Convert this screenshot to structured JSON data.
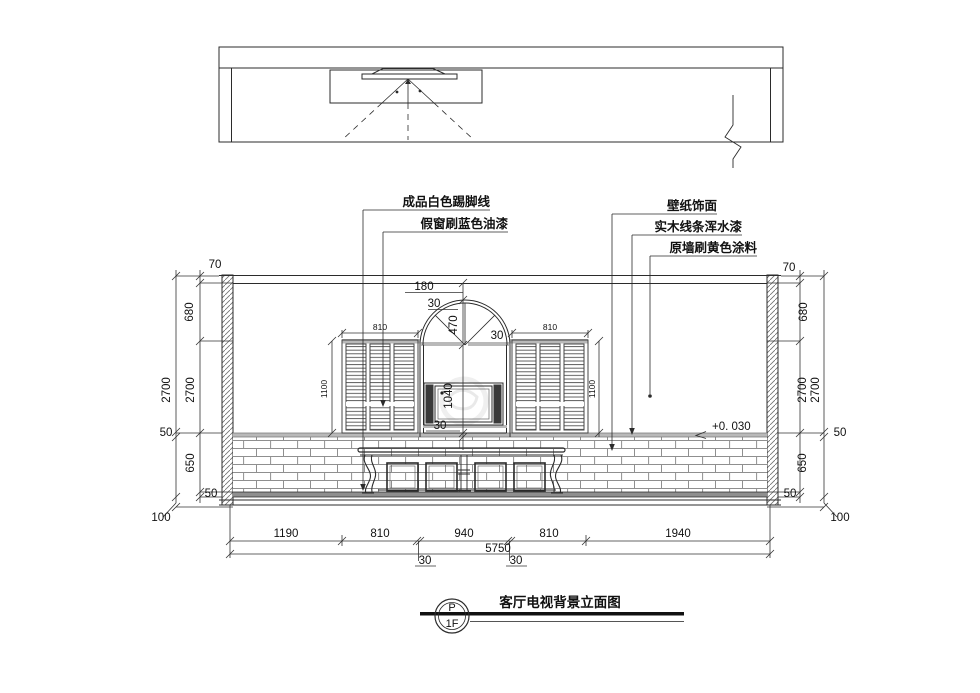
{
  "title_block": {
    "symbol_top": "P",
    "symbol_bottom": "1F",
    "title": "客厅电视背景立面图"
  },
  "callouts": {
    "left": [
      "成品白色踢脚线",
      "假窗刷蓝色油漆"
    ],
    "right": [
      "壁纸饰面",
      "实木线条浑水漆",
      "原墙刷黄色涂料"
    ]
  },
  "dims": {
    "left_inner": [
      "70",
      "680",
      "2700",
      "650",
      "50"
    ],
    "left_outer": [
      "2700",
      "50",
      "100"
    ],
    "right_inner": [
      "70",
      "680",
      "2700",
      "650",
      "50"
    ],
    "right_outer": [
      "2700",
      "50",
      "100"
    ],
    "center": [
      "180",
      "30",
      "470",
      "30",
      "1040",
      "30"
    ],
    "window_width": "810",
    "window_height": "1100",
    "bottom_row": [
      "1190",
      "810",
      "940",
      "810",
      "1940"
    ],
    "bottom_gaps": [
      "30",
      "30"
    ],
    "total": "5750",
    "level": "+0. 030"
  },
  "colors": {
    "line": "#2b2b2b",
    "grey_band": "#b9b9b9",
    "mortar": "#8f8f8f",
    "dark_fill": "#3a3a3a"
  }
}
